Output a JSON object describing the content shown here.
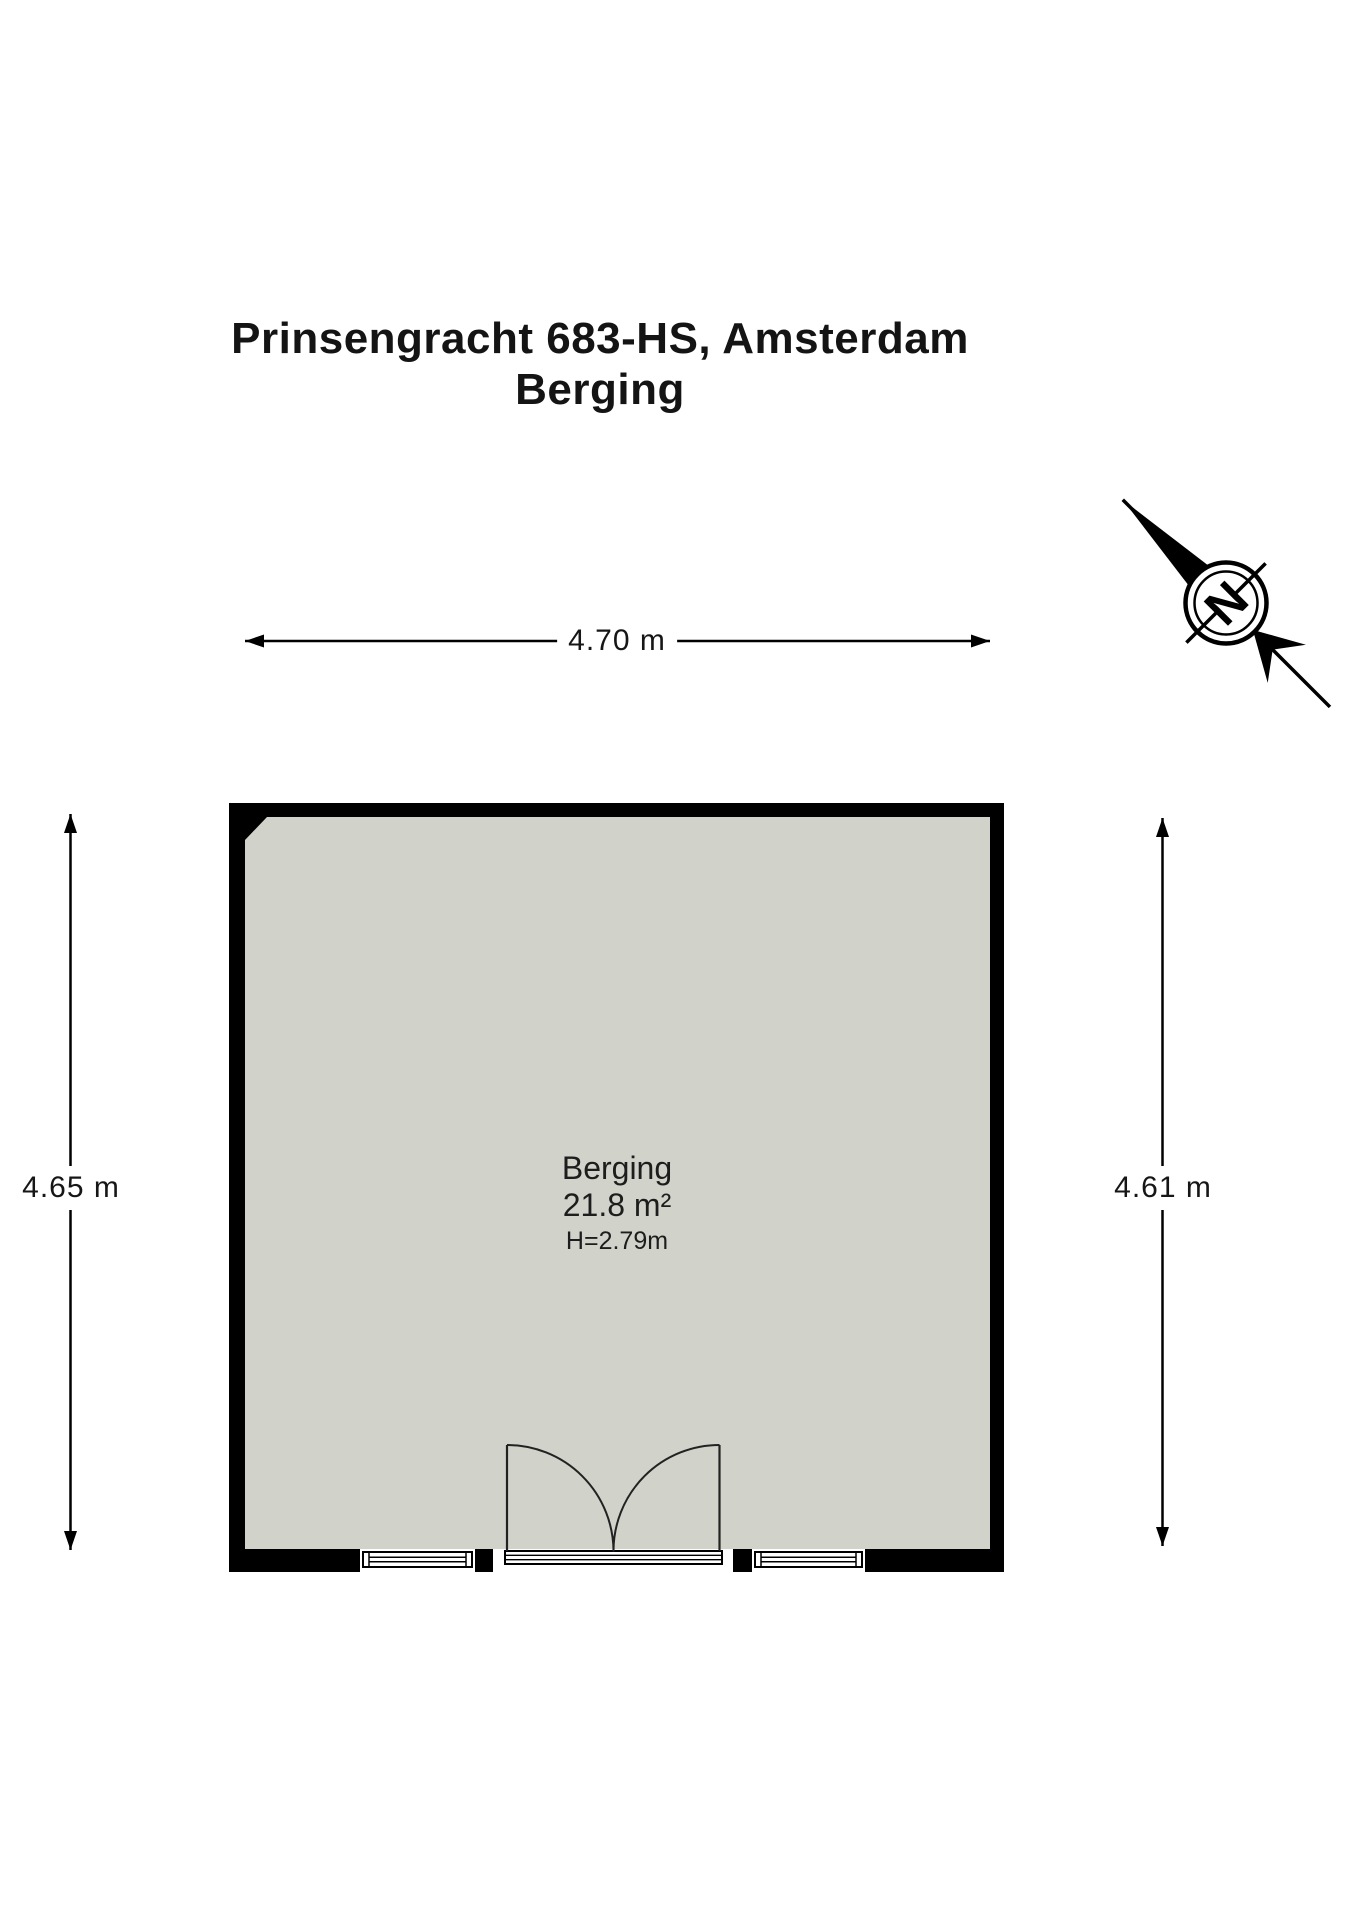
{
  "title": {
    "line1": "Prinsengracht 683-HS, Amsterdam",
    "line2": "Berging"
  },
  "compass": {
    "north_label": "N"
  },
  "dimensions": {
    "width_top": "4.70 m",
    "height_left": "4.65 m",
    "height_right": "4.61 m"
  },
  "room": {
    "name": "Berging",
    "area": "21.8 m²",
    "ceiling_height": "H=2.79m"
  },
  "colors": {
    "floor": "#d1d2ca",
    "wall": "#000000",
    "line": "#000000",
    "background": "#ffffff"
  }
}
